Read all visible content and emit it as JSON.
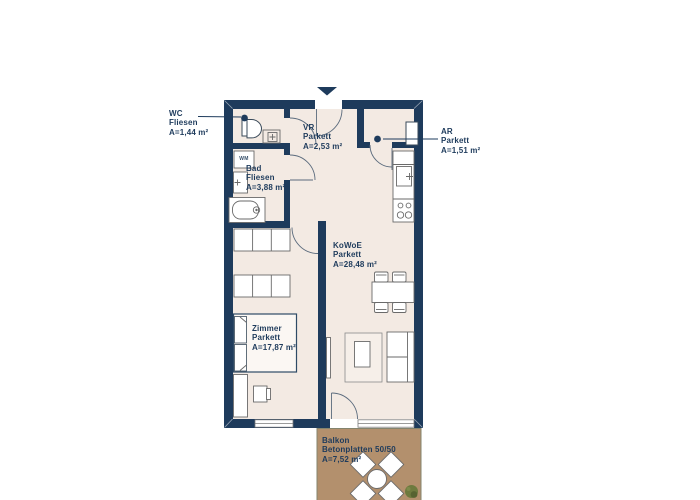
{
  "colors": {
    "wall": "#1e3b5c",
    "floor": "#f3eae3",
    "balcony": "#b3906d",
    "furniture_stroke": "#6a6a6a",
    "window_frame": "#7a7a7a",
    "plant": "#6d7a3e",
    "text": "#1e3b5c",
    "background": "#ffffff"
  },
  "rooms": {
    "wc": {
      "name": "WC",
      "material": "Fliesen",
      "area": "A=1,44 m²"
    },
    "vr": {
      "name": "VR",
      "material": "Parkett",
      "area": "A=2,53 m²"
    },
    "ar": {
      "name": "AR",
      "material": "Parkett",
      "area": "A=1,51 m²"
    },
    "bad": {
      "name": "Bad",
      "material": "Fliesen",
      "area": "A=3,88 m²"
    },
    "kowoe": {
      "name": "KoWoE",
      "material": "Parkett",
      "area": "A=28,48 m²"
    },
    "zimmer": {
      "name": "Zimmer",
      "material": "Parkett",
      "area": "A=17,87 m²"
    },
    "balkon": {
      "name": "Balkon",
      "material": "Betonplatten 50/50",
      "area": "A=7,52 m²"
    }
  },
  "appliances": {
    "washer_label": "WM"
  }
}
